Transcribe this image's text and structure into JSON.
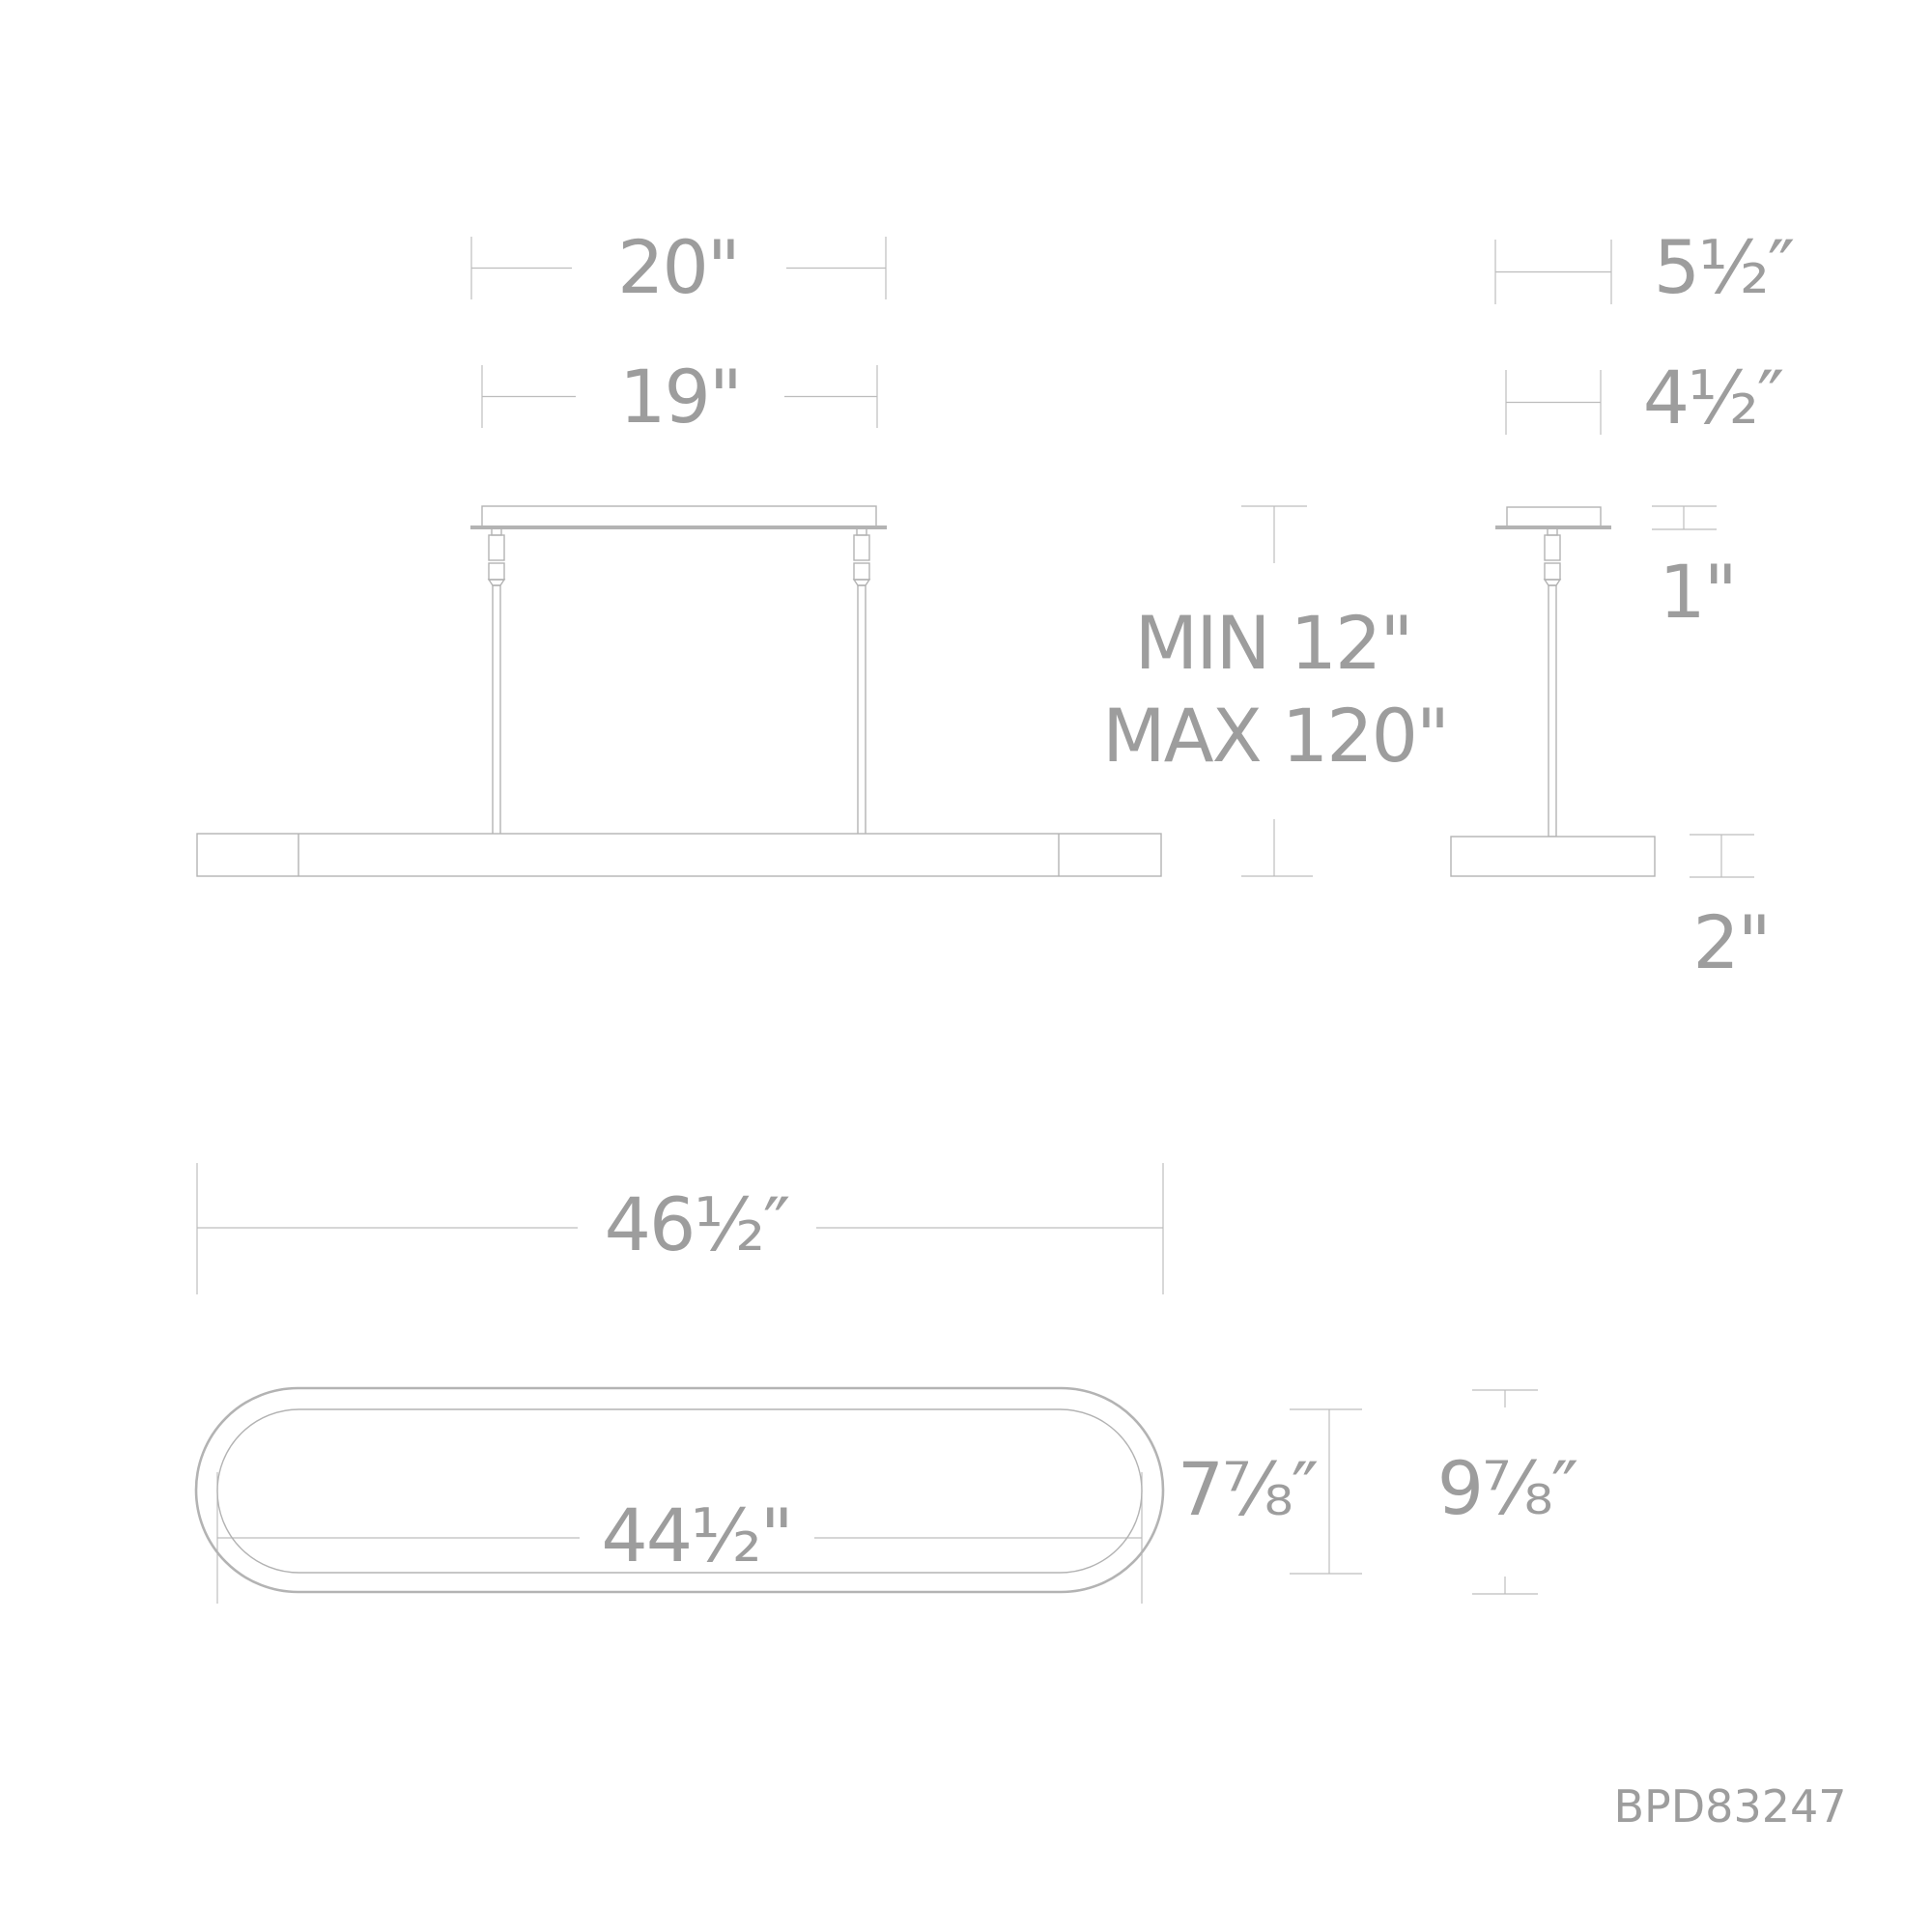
{
  "document": {
    "type": "luminaire-dimension-diagram",
    "part_number": "BPD83247",
    "background": "#ffffff"
  },
  "colors": {
    "line": "#b3b3b3",
    "dim_line": "#bdbdbd",
    "text": "#9d9d9d"
  },
  "views": {
    "front": {
      "dims": {
        "canopy_width": "20\"",
        "mount_width": "19\"",
        "suspension_min": "MIN 12\"",
        "suspension_max": "MAX 120\""
      }
    },
    "side": {
      "dims": {
        "plate_width": "5½″",
        "canopy_width": "4½″",
        "canopy_height": "1\"",
        "body_height": "2\""
      }
    },
    "top": {
      "dims": {
        "outer_length": "46½″",
        "inner_length": "44½\"",
        "inner_width": "7⅞″",
        "outer_width": "9⅞″"
      }
    }
  }
}
